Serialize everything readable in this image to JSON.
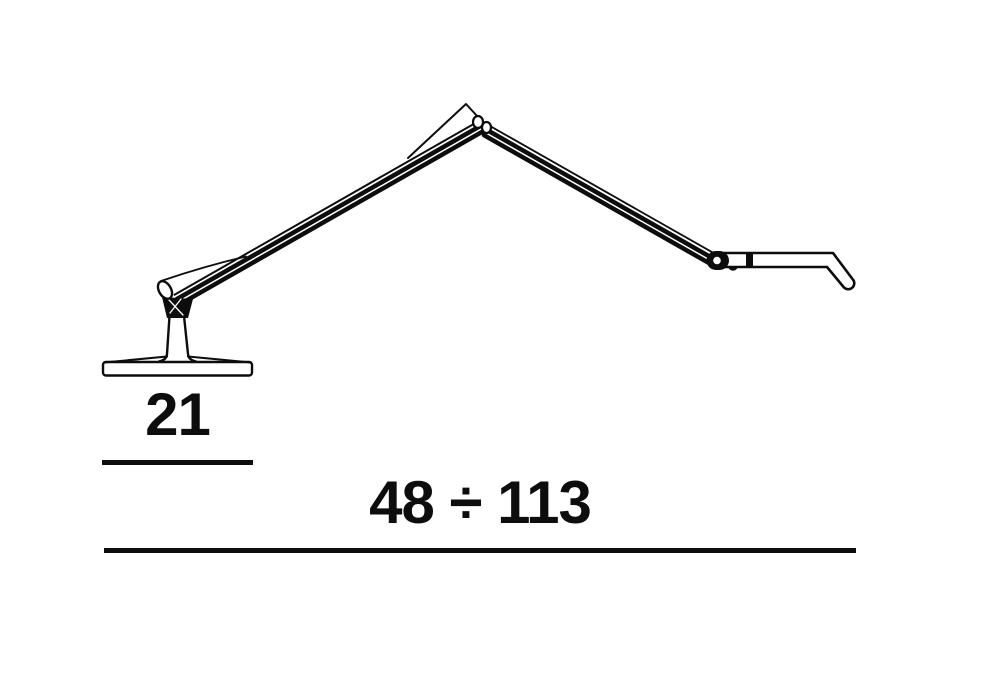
{
  "figure": {
    "name": "articulated-desk-lamp-line-drawing",
    "view": "side"
  },
  "colors": {
    "ink": "#0d0d0d",
    "background": "#ffffff"
  },
  "dimensions": {
    "base_width": {
      "label": "21"
    },
    "extension_range": {
      "label": "48 ÷ 113"
    }
  }
}
